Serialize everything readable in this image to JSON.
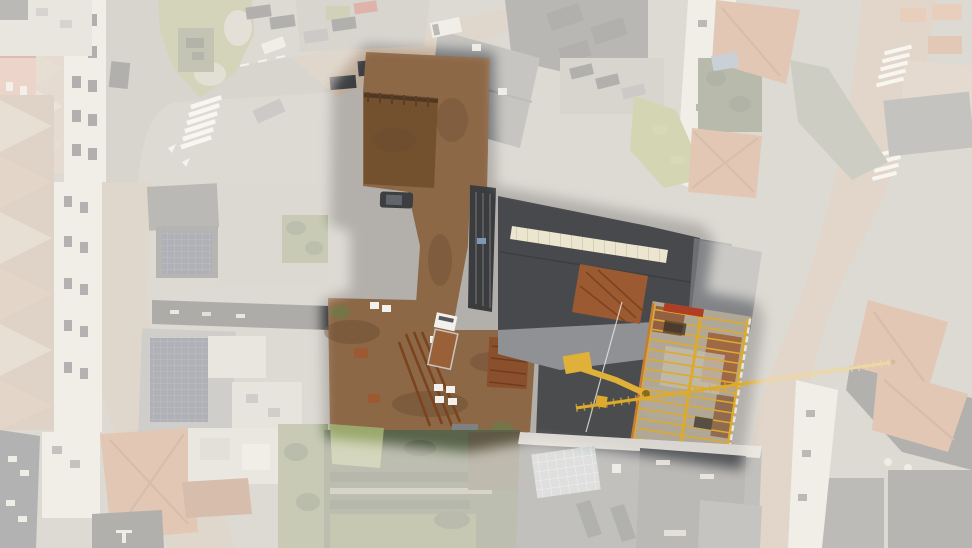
{
  "scene": {
    "type": "aerial-drone-photograph",
    "subject": "town-block-with-highlighted-construction-plot",
    "highlight": "central construction site shown saturated, surroundings faded white",
    "visible_text": ""
  },
  "colors": {
    "pavement": "#b3b0ab",
    "roadGray": "#a6a4a0",
    "roadBrick": "#bdab99",
    "brickStreetRight": "#c2a492",
    "plazaPink": "#c9b2a2",
    "islandGreen": "#99a266",
    "gardenGreen": "#7a8758",
    "gardenDark": "#59644a",
    "lawnLight": "#9aa86d",
    "sedum": "#97a452",
    "roofDarkGray": "#55575a",
    "roofCharcoal": "#47494c",
    "roofMidGray": "#77797c",
    "roofLightGray": "#c9c6c1",
    "roofWhite": "#dcd9d4",
    "roofOrange": "#c07d55",
    "roofOrangeDark": "#a4613d",
    "roofRed": "#b85c41",
    "facadeSalmon": "#dca291",
    "facadeWhite": "#eae7e2",
    "navyRoof": "#3e4450",
    "solarBlue": "#33415c",
    "solarLine": "#5f7090",
    "glassBlue": "#b7c1c9",
    "skylightCream": "#ece5cf",
    "skylightLine": "#c2ba9e",
    "dirtBrown": "#8d6847",
    "pitBrown": "#73512f",
    "dirtDark": "#6b4c31",
    "rustOrange": "#9c5a32",
    "rustDark": "#7c431f",
    "craneYellow": "#dcab2d",
    "machineYellow": "#e0b139",
    "truckWhite": "#f2f1ee",
    "carDark": "#3c3e42",
    "carGray": "#85878a",
    "carRed": "#b5453a",
    "carWhite": "#eceae6",
    "blueTarp": "#7e97b8",
    "concrete": "#b1a797",
    "darkGround": "#4a4c4e",
    "stone": "#c6c3ba",
    "whiteMark": "#f4f2ee",
    "overlay": "#f5f1ea"
  }
}
